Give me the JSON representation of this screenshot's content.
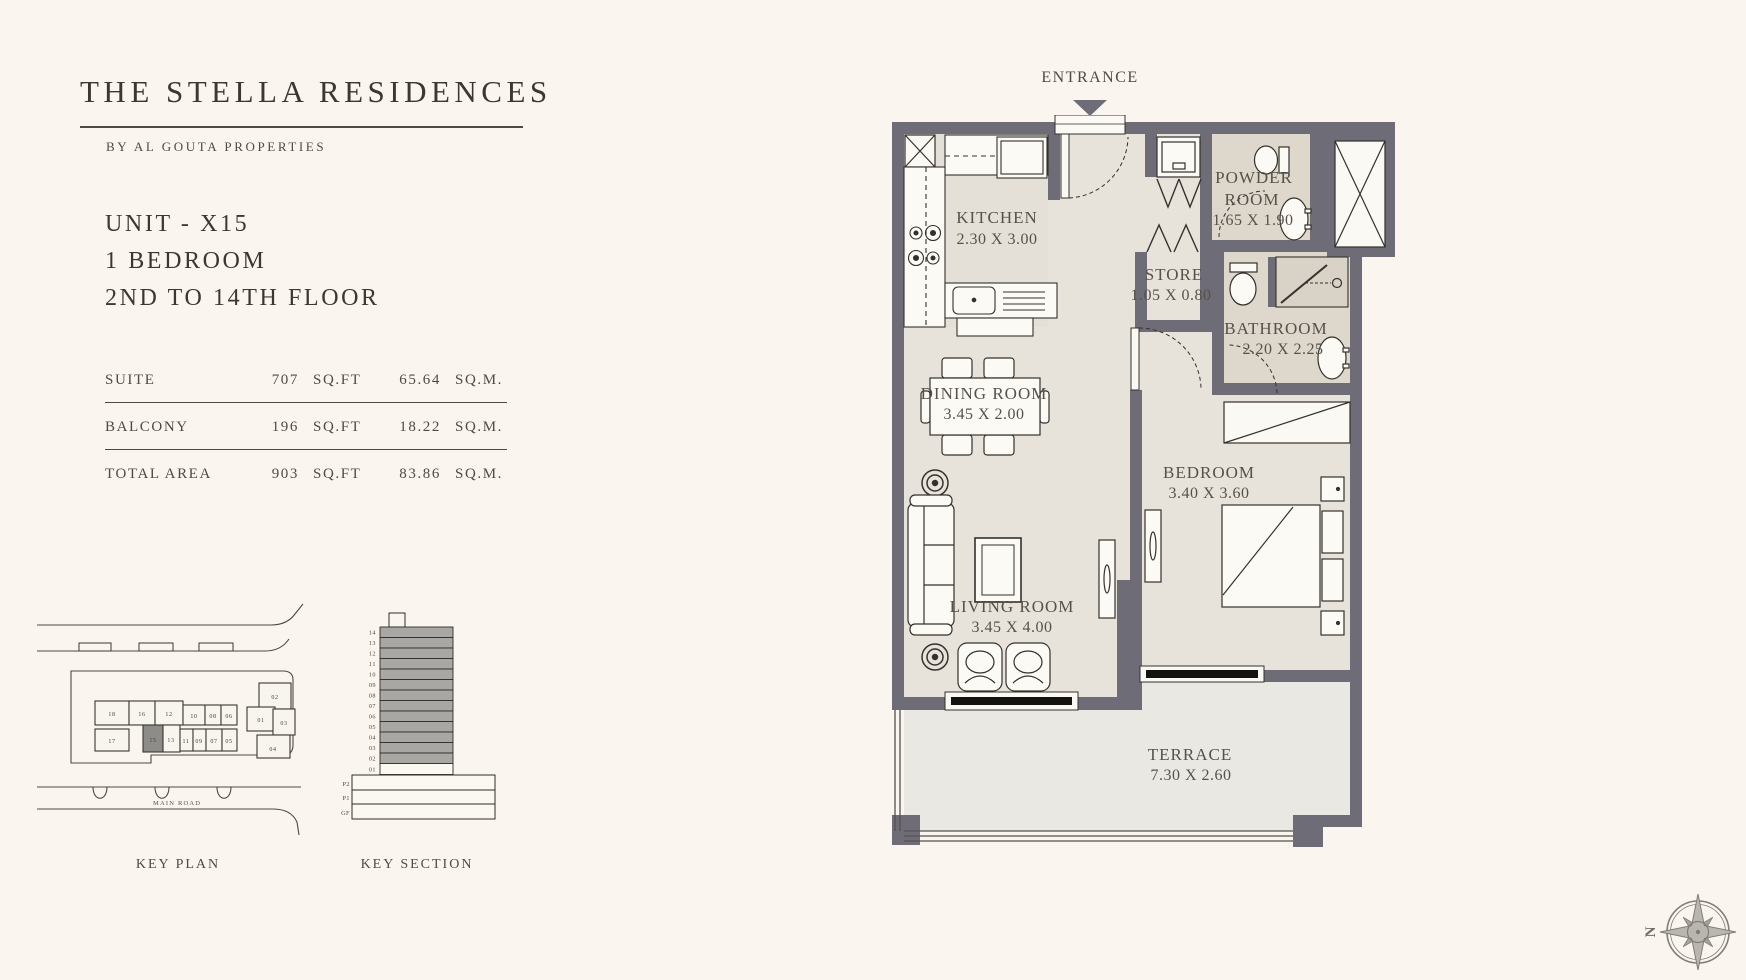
{
  "colors": {
    "page-bg": "#faf6ef",
    "ink": "#3b3733",
    "soft-ink": "#4e4a44",
    "label-ink": "#56524b",
    "rule": "#4e4a44",
    "wall": "#6e6d77",
    "floor": "#e7e3da",
    "floor-kitchen": "#e4e0d7",
    "floor-wet": "#ddd8cb",
    "floor-terrace": "#e9e8e3",
    "fixture-fill": "#fcfaf5",
    "fixture-line": "#34312d",
    "keyplan-highlight": "#8d8c89",
    "section-floor-fill": "#a9a7a3",
    "compass-line": "#807d78"
  },
  "header": {
    "title": "THE STELLA RESIDENCES",
    "subtitle": "BY AL GOUTA PROPERTIES"
  },
  "unit_info": {
    "unit": "UNIT - X15",
    "type": "1 BEDROOM",
    "floors": "2ND TO 14TH FLOOR"
  },
  "area_table": {
    "rows": [
      {
        "label": "SUITE",
        "imperial_value": "707",
        "imperial_unit": "SQ.FT",
        "metric_value": "65.64",
        "metric_unit": "SQ.M."
      },
      {
        "label": "BALCONY",
        "imperial_value": "196",
        "imperial_unit": "SQ.FT",
        "metric_value": "18.22",
        "metric_unit": "SQ.M."
      },
      {
        "label": "TOTAL AREA",
        "imperial_value": "903",
        "imperial_unit": "SQ.FT",
        "metric_value": "83.86",
        "metric_unit": "SQ.M."
      }
    ]
  },
  "key_plan": {
    "caption": "KEY PLAN",
    "road_label": "MAIN ROAD",
    "highlighted_unit": "15",
    "row1_units": [
      "18",
      "16",
      "12",
      "10",
      "08",
      "06"
    ],
    "row2_units": [
      "17",
      "15",
      "13",
      "11",
      "09",
      "07",
      "05"
    ],
    "cluster_units": [
      "02",
      "01",
      "03",
      "04"
    ]
  },
  "key_section": {
    "caption": "KEY SECTION",
    "tower_floors": [
      "14",
      "13",
      "12",
      "11",
      "10",
      "09",
      "08",
      "07",
      "06",
      "05",
      "04",
      "03",
      "02",
      "01"
    ],
    "podium_levels": [
      "P2",
      "P1",
      "GF"
    ]
  },
  "plan": {
    "entrance_label": "ENTRANCE",
    "rooms": {
      "kitchen": {
        "name": "KITCHEN",
        "dims": "2.30 X 3.00"
      },
      "powder": {
        "name_line1": "POWDER",
        "name_line2": "ROOM",
        "dims": "1.65 X 1.90"
      },
      "store": {
        "name": "STORE",
        "dims": "1.05 X 0.80"
      },
      "bathroom": {
        "name": "BATHROOM",
        "dims": "2.20 X 2.25"
      },
      "dining": {
        "name": "DINING ROOM",
        "dims": "3.45 X 2.00"
      },
      "bedroom": {
        "name": "BEDROOM",
        "dims": "3.40 X 3.60"
      },
      "living": {
        "name": "LIVING ROOM",
        "dims": "3.45 X 4.00"
      },
      "terrace": {
        "name": "TERRACE",
        "dims": "7.30 X 2.60"
      }
    }
  },
  "compass": {
    "north_label": "N"
  }
}
